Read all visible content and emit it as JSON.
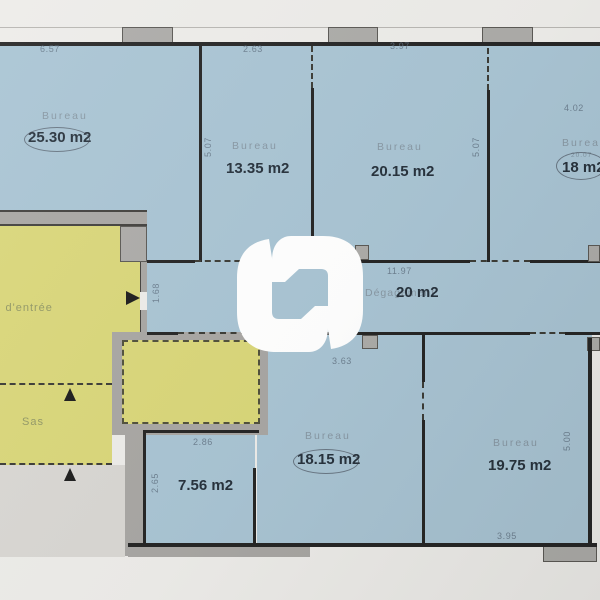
{
  "document": {
    "type": "floor-plan",
    "units": "m2"
  },
  "rooms": {
    "bureau1": {
      "label": "Bureau",
      "area": "25.30 m2",
      "dim_top": "6.57"
    },
    "bureau2": {
      "label": "Bureau",
      "area": "13.35 m2",
      "dim_top": "2.63",
      "dim_left": "5.07"
    },
    "bureau3": {
      "label": "Bureau",
      "area": "20.15 m2",
      "dim_top": "3.97",
      "dim_right": "5.07"
    },
    "bureau4": {
      "label": "Bureau",
      "area": "18 m2",
      "printed_area": "20.07",
      "dim_top": "4.02"
    },
    "corridor": {
      "label": "Dégagement",
      "area": "20 m2",
      "dim_top": "11.97",
      "dim_left": "1.68"
    },
    "hall": {
      "label": "l d'entrée"
    },
    "sas": {
      "label": "Sas"
    },
    "room756": {
      "area": "7.56 m2",
      "dim_top": "2.86",
      "dim_left": "2.65"
    },
    "bureau5": {
      "label": "Bureau",
      "area": "18.15 m2",
      "dim_top": "3.63"
    },
    "bureau6": {
      "label": "Bureau",
      "area": "19.75 m2",
      "dim_right": "5.00",
      "dim_bottom": "3.95"
    }
  },
  "colors": {
    "room_blue": "#a6c2d2",
    "room_yellow": "#d8d575",
    "wall_gray": "#a5a3a0",
    "wall_line": "#1e1e1e",
    "watermark": "#ffffff"
  }
}
